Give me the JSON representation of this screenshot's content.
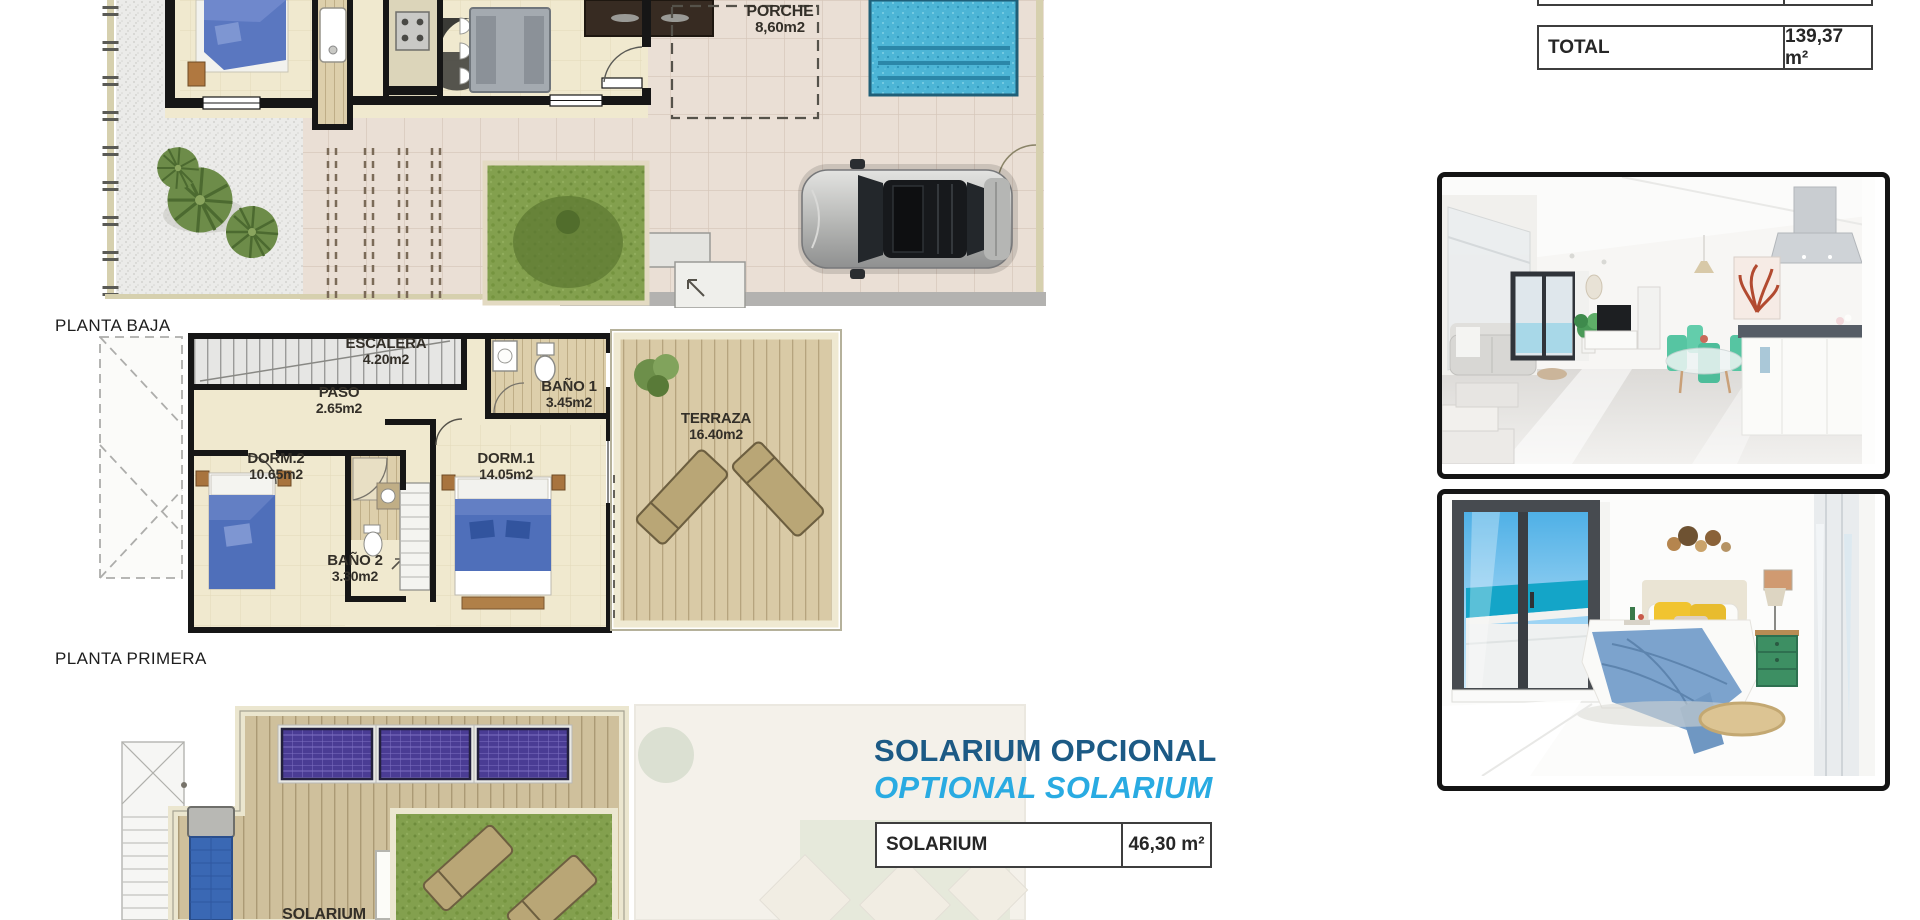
{
  "summary_table": {
    "total_label": "TOTAL",
    "total_value": "139,37 m²"
  },
  "solarium_section": {
    "title_primary": "SOLARIUM OPCIONAL",
    "title_secondary": "OPTIONAL SOLARIUM",
    "table_label": "SOLARIUM",
    "table_value": "46,30 m²"
  },
  "ground_floor": {
    "caption": "PLANTA BAJA",
    "rooms": [
      {
        "name": "PORCHE",
        "area": "8,60m2"
      }
    ]
  },
  "first_floor": {
    "caption": "PLANTA PRIMERA",
    "rooms": [
      {
        "name": "ESCALERA",
        "area": "4.20m2"
      },
      {
        "name": "PASO",
        "area": "2.65m2"
      },
      {
        "name": "BAÑO 1",
        "area": "3.45m2"
      },
      {
        "name": "TERRAZA",
        "area": "16.40m2"
      },
      {
        "name": "DORM.2",
        "area": "10.65m2"
      },
      {
        "name": "DORM.1",
        "area": "14.05m2"
      },
      {
        "name": "BAÑO 2",
        "area": "3.30m2"
      }
    ]
  },
  "solarium_floor": {
    "caption": "SOLARIUM"
  },
  "colors": {
    "title_primary": "#1c5a85",
    "title_secondary": "#29abe2",
    "pool": "#4cb5d6",
    "solar_panel": "#4a3c94",
    "turf": "#83a04e",
    "bed_blue": "#4f6fba"
  }
}
